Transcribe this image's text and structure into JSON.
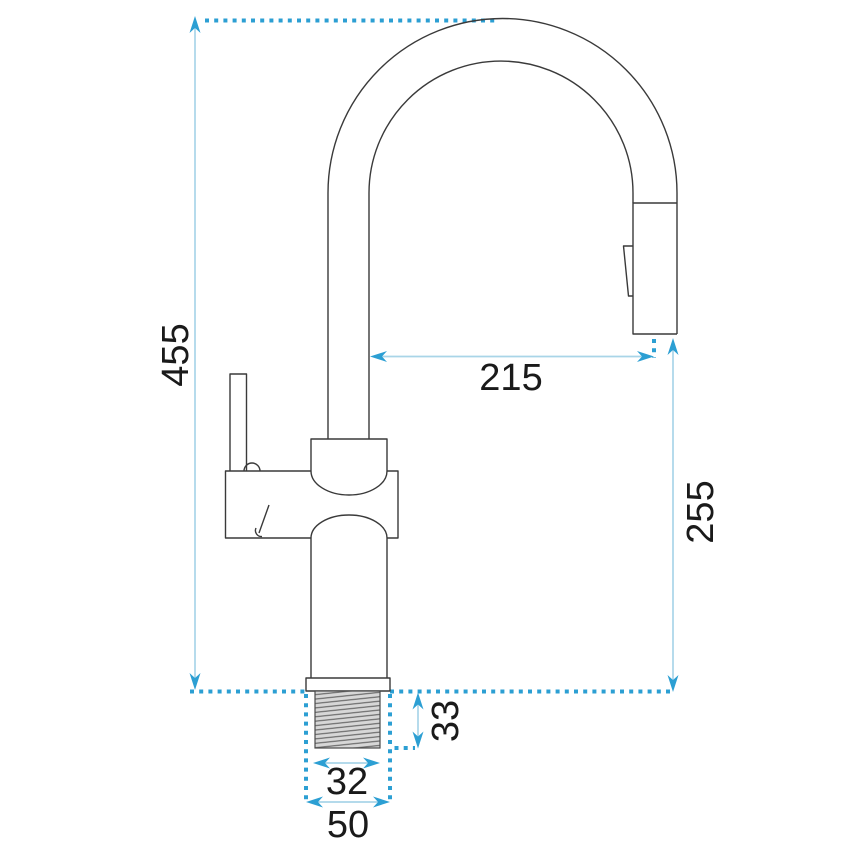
{
  "diagram_type": "technical-dimension-drawing",
  "subject": "kitchen faucet with pull-out spray head, side view",
  "dimensions": {
    "overall_height": "455",
    "spout_reach": "215",
    "outlet_height": "255",
    "thread_length": "33",
    "thread_width": "32",
    "base_width": "50"
  },
  "colors": {
    "drawing_line": "#3a3a3a",
    "dimension_line": "#a9d5e8",
    "dimension_accent": "#2c9fd3",
    "label_text": "#1a1a1a",
    "thread_fill": "#d7d7d7"
  }
}
